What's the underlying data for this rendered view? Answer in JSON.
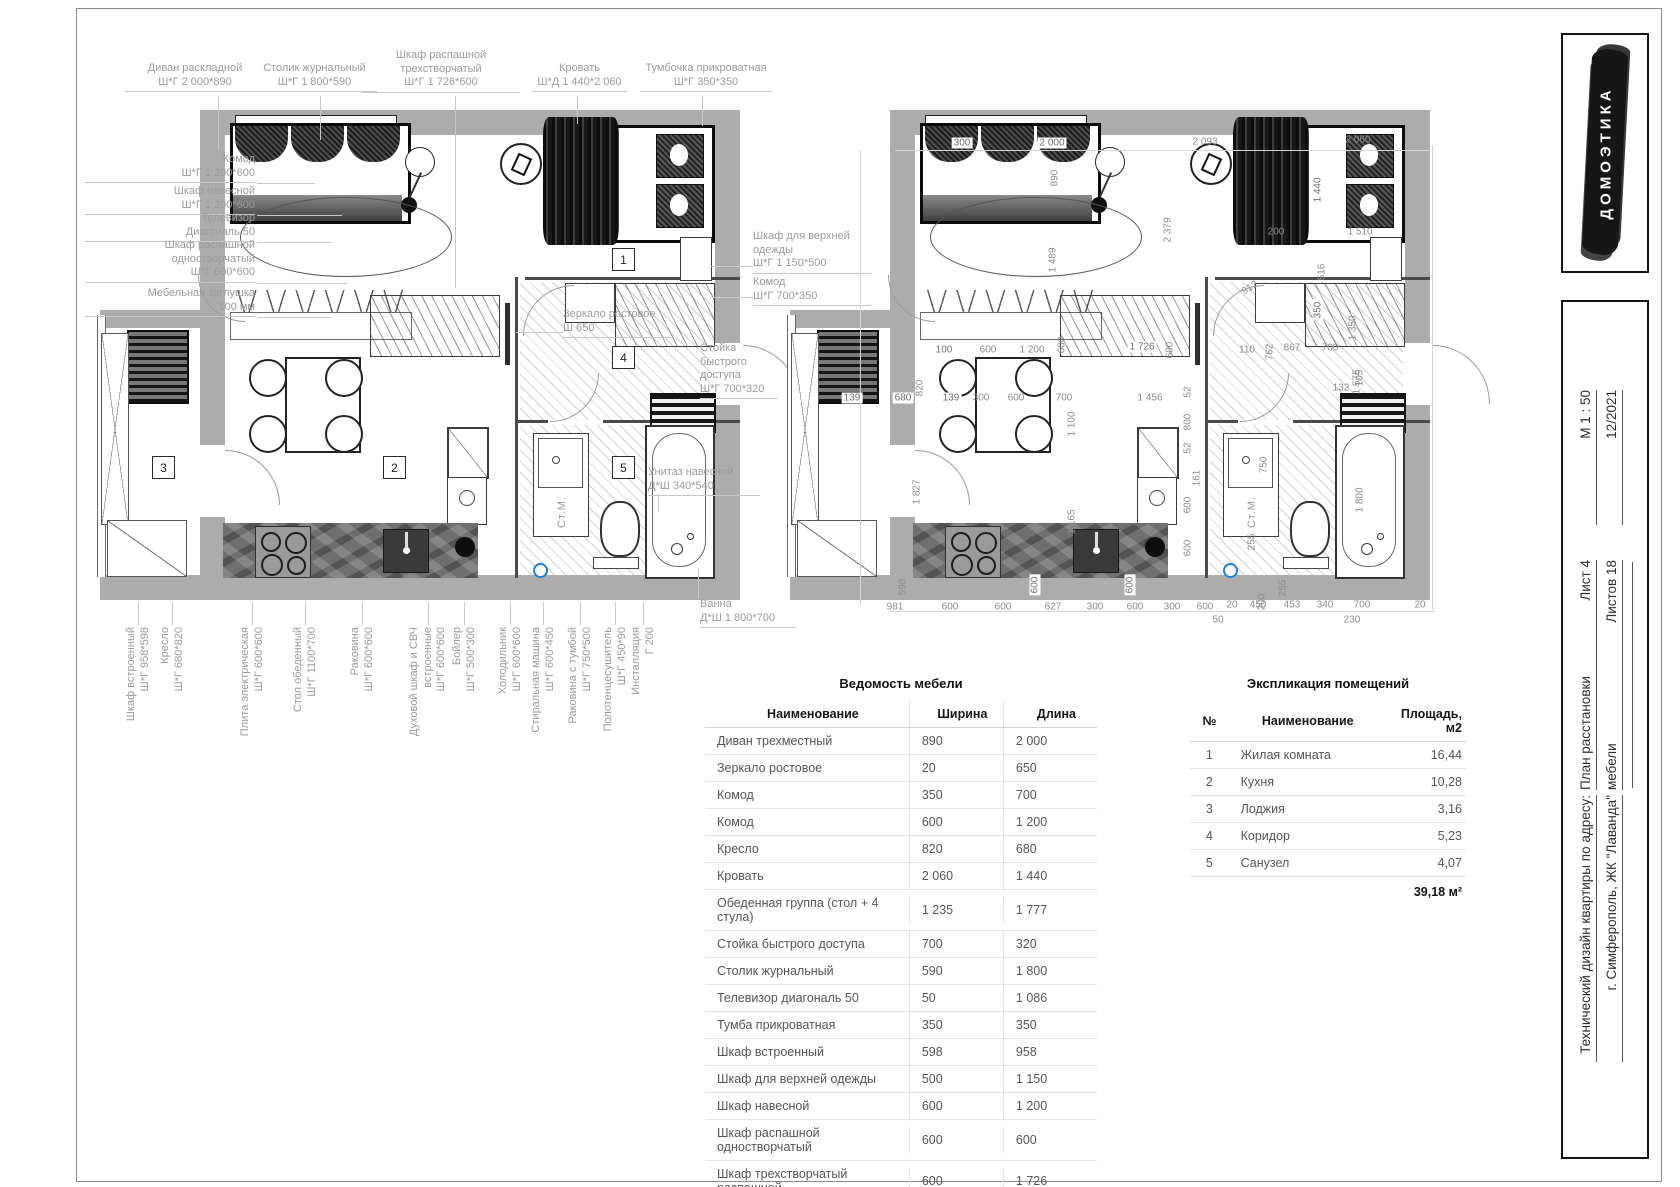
{
  "logo": {
    "text": "ДОМОЭТИКА"
  },
  "title_block": {
    "scale": "М 1 : 50",
    "date": "12/2021",
    "sheet": "Лист 4",
    "sheets_total": "Листов 18",
    "doc_title_1": "План расстановки",
    "doc_title_2": "мебели",
    "project_1": "Технический дизайн квартиры по адресу:",
    "project_2": "г. Симферополь, ЖК \"Лаванда\""
  },
  "left_plan": {
    "room_numbers": [
      "1",
      "2",
      "3",
      "4",
      "5"
    ],
    "washer_label": "Ст.М.",
    "callouts_top": [
      {
        "name": "Диван раскладной",
        "dims": "Ш*Г 2 000*890"
      },
      {
        "name": "Столик журнальный",
        "dims": "Ш*Г 1 800*590"
      },
      {
        "name": "Шкаф распашной\nтрехстворчатый",
        "dims": "Ш*Г 1 726*600"
      },
      {
        "name": "Кровать",
        "dims": "Ш*Д 1 440*2 060"
      },
      {
        "name": "Тумбочка прикроватная",
        "dims": "Ш*Г 350*350"
      }
    ],
    "callouts_left": [
      {
        "name": "Комод",
        "dims": "Ш*Г 1 200*600"
      },
      {
        "name": "Шкаф навесной",
        "dims": "Ш*Г 1 200*600"
      },
      {
        "name": "Телевизор",
        "dims": "Диагональ 50"
      },
      {
        "name": "Шкаф распашной\nодностворчатый",
        "dims": "Ш*Г 600*600"
      },
      {
        "name": "Мебельная заглушка",
        "dims": "100 мм"
      }
    ],
    "callouts_right": [
      {
        "name": "Шкаф для верхней\nодежды",
        "dims": "Ш*Г 1 150*500"
      },
      {
        "name": "Комод",
        "dims": "Ш*Г 700*350"
      },
      {
        "name": "Зеркало ростовое",
        "dims": "Ш 650"
      },
      {
        "name": "Стойка\nбыстрого\nдоступа",
        "dims": "Ш*Г 700*320"
      },
      {
        "name": "Унитаз навесной",
        "dims": "Д*Ш 340*540"
      },
      {
        "name": "Ванна",
        "dims": "Д*Ш 1 800*700"
      }
    ],
    "callouts_bottom": [
      {
        "name": "Шкаф встроенный",
        "dims": "Ш*Г 958*598"
      },
      {
        "name": "Кресло",
        "dims": "Ш*Г 680*820"
      },
      {
        "name": "Плита электрическая",
        "dims": "Ш*Г 600*600"
      },
      {
        "name": "Стол обеденный",
        "dims": "Ш*Г 1100*700"
      },
      {
        "name": "Раковина",
        "dims": "Ш*Г 600*600"
      },
      {
        "name": "Духовой шкаф и СВЧ\nвстроенные",
        "dims": "Ш*Г 600*600"
      },
      {
        "name": "Бойлер",
        "dims": "Ш*Г 500*300"
      },
      {
        "name": "Холодильник",
        "dims": "Ш*Г 600*600"
      },
      {
        "name": "Стиральная машина",
        "dims": "Ш*Г 600*450"
      },
      {
        "name": "Раковина с тумбой",
        "dims": "Ш*Г 750*500"
      },
      {
        "name": "Полотенцесушитель",
        "dims": "Ш*Г 450*90"
      },
      {
        "name": "Инсталляция",
        "dims": "Г 200"
      }
    ]
  },
  "right_plan": {
    "dims": [
      "300",
      "2 000",
      "890",
      "2 093",
      "2 060",
      "1 440",
      "200",
      "1 510",
      "2 379",
      "1 489",
      "516",
      "912",
      "350",
      "100",
      "600",
      "1 200",
      "600",
      "1 726",
      "600",
      "110",
      "762",
      "867",
      "700",
      "1 575",
      "139",
      "680",
      "820",
      "139",
      "300",
      "600",
      "700",
      "1 456",
      "52",
      "1 100",
      "800",
      "52",
      "161",
      "600",
      "600",
      "1 827",
      "1 165",
      "598",
      "600",
      "600",
      "255",
      "200",
      "1 350",
      "105",
      "132",
      "1 800",
      "750",
      "255",
      "981",
      "600",
      "600",
      "627",
      "300",
      "600",
      "300",
      "600",
      "20",
      "450",
      "453",
      "340",
      "700",
      "20",
      "230",
      "50"
    ]
  },
  "furniture_table": {
    "title": "Ведомость мебели",
    "headers": [
      "Наименование",
      "Ширина",
      "Длина"
    ],
    "rows": [
      [
        "Диван трехместный",
        "890",
        "2 000"
      ],
      [
        "Зеркало ростовое",
        "20",
        "650"
      ],
      [
        "Комод",
        "350",
        "700"
      ],
      [
        "Комод",
        "600",
        "1 200"
      ],
      [
        "Кресло",
        "820",
        "680"
      ],
      [
        "Кровать",
        "2 060",
        "1 440"
      ],
      [
        "Обеденная группа (стол + 4 стула)",
        "1 235",
        "1 777"
      ],
      [
        "Стойка быстрого доступа",
        "700",
        "320"
      ],
      [
        "Столик журнальный",
        "590",
        "1 800"
      ],
      [
        "Телевизор диагональ 50",
        "50",
        "1 086"
      ],
      [
        "Тумба прикроватная",
        "350",
        "350"
      ],
      [
        "Шкаф встроенный",
        "598",
        "958"
      ],
      [
        "Шкаф для верхней одежды",
        "500",
        "1 150"
      ],
      [
        "Шкаф навесной",
        "600",
        "1 200"
      ],
      [
        "Шкаф распашной одностворчатый",
        "600",
        "600"
      ],
      [
        "Шкаф трехстворчатый распашной",
        "600",
        "1 726"
      ]
    ]
  },
  "explication_table": {
    "title": "Экспликация помещений",
    "headers": [
      "№",
      "Наименование",
      "Площадь, м2"
    ],
    "rows": [
      [
        "1",
        "Жилая комната",
        "16,44"
      ],
      [
        "2",
        "Кухня",
        "10,28"
      ],
      [
        "3",
        "Лоджия",
        "3,16"
      ],
      [
        "4",
        "Коридор",
        "5,23"
      ],
      [
        "5",
        "Санузел",
        "4,07"
      ]
    ],
    "total": "39,18 м²"
  }
}
